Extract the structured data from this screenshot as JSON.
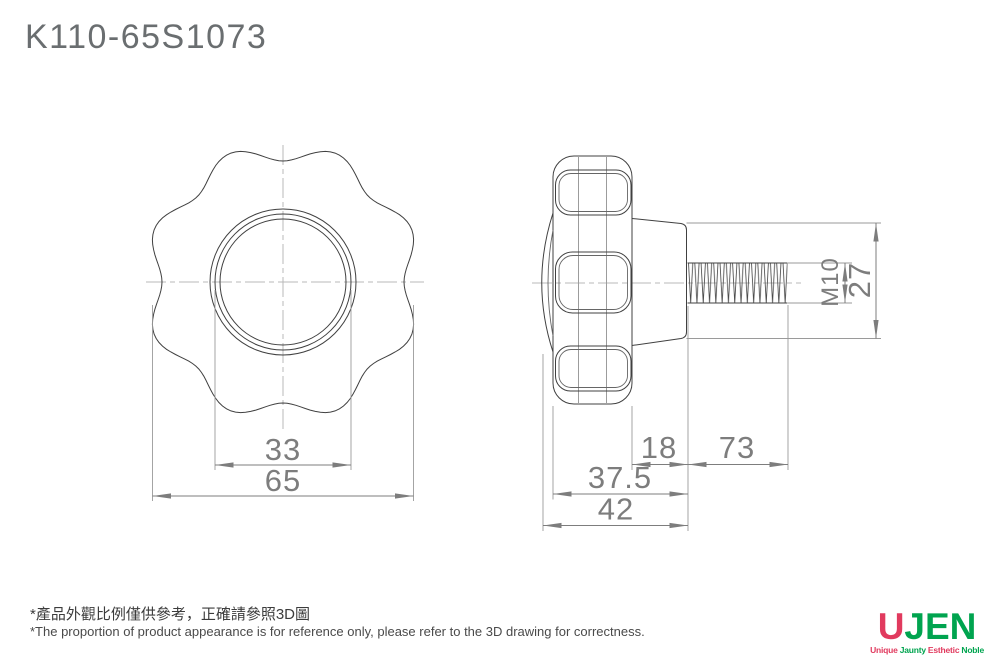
{
  "title": "K110-65S1073",
  "front_view": {
    "dim_hub_circle_diameter": "33",
    "dim_knob_outer_diameter": "65"
  },
  "side_view": {
    "dim_boss_length": "18",
    "dim_thread_length": "73",
    "dim_knob_plus_boss_length": "37.5",
    "dim_overall_body_length": "42",
    "dim_thread_spec": "M10",
    "dim_boss_diameter": "27"
  },
  "footnote": {
    "zh": "*產品外觀比例僅供參考，正確請參照3D圖",
    "en": "*The proportion of product appearance is for reference only, please refer to the 3D drawing for correctness."
  },
  "logo": {
    "brand_first_letter": "U",
    "brand_rest": "JEN",
    "tagline_words": [
      "Unique",
      "Jaunty",
      "Esthetic",
      "Noble"
    ],
    "color_red": "#e13a5e",
    "color_green": "#00a44f"
  },
  "colors": {
    "object_line": "#404040",
    "dimension_line": "#7d7d7d",
    "extension_line": "#9a9a9a",
    "centerline": "#b8b8b8",
    "background": "#ffffff"
  }
}
